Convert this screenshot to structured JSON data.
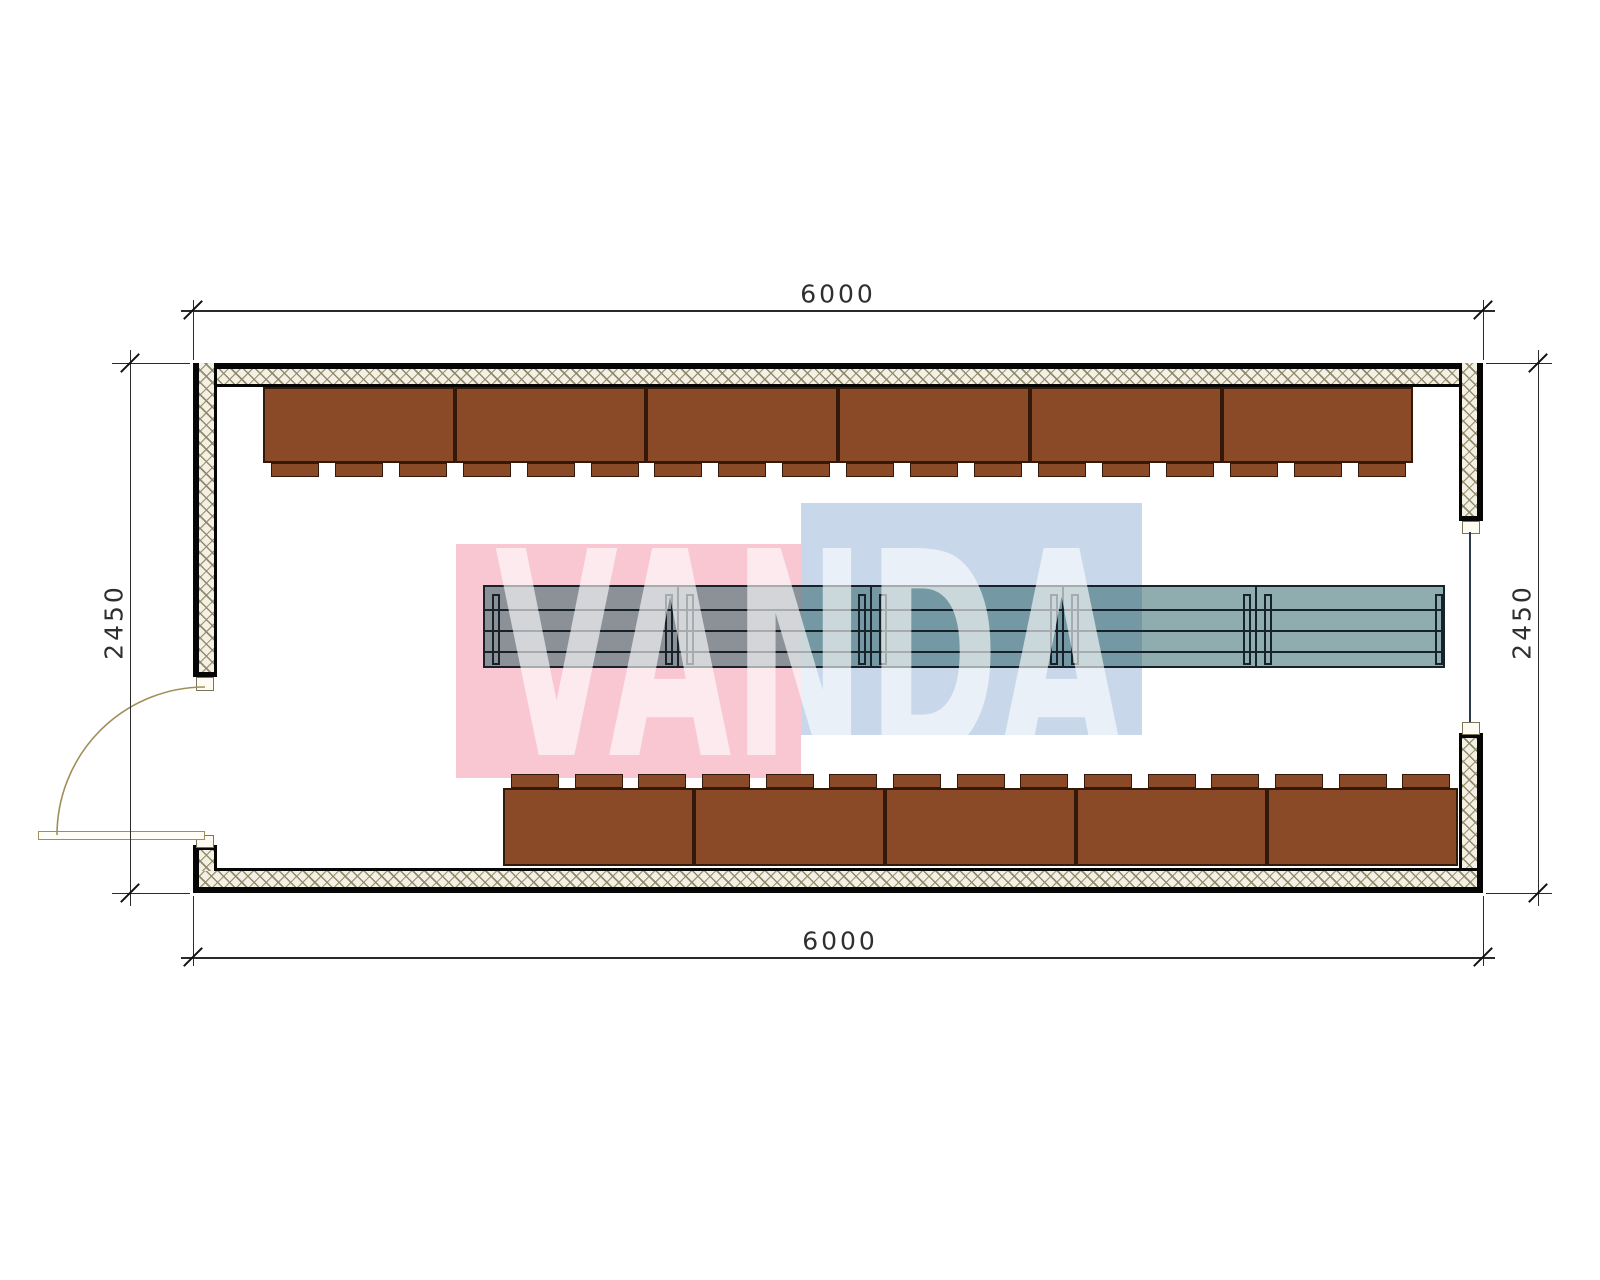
{
  "title": "container-floor-plan",
  "dimensions": {
    "top": {
      "label": "6000"
    },
    "bottom": {
      "label": "6000"
    },
    "left": {
      "label": "2450"
    },
    "right": {
      "label": "2450"
    }
  },
  "watermark": {
    "text": "VANDA",
    "pink_color": "#f8c7d2",
    "blue_color": "#c9d7ea",
    "text_color": "rgba(255,255,255,0.62)",
    "rects": [
      {
        "x": 456,
        "y": 544,
        "w": 345,
        "h": 234,
        "which": "pink"
      },
      {
        "x": 801,
        "y": 503,
        "w": 341,
        "h": 232,
        "which": "blue"
      }
    ],
    "text_box": {
      "left": 495,
      "top": 548,
      "font_px": 284,
      "line_px": 218,
      "scale_x": 0.56,
      "letter_spacing": 2
    }
  },
  "plan": {
    "colors": {
      "wall_border": "#060606",
      "bench_fill": "#8a4a28",
      "bench_border": "#33190a",
      "table_fill": "rgba(40,95,100,0.52)",
      "table_line": "#17222b",
      "door": "#9f8f5a",
      "dim_line": "#2a2a2a",
      "dim_text": "#2f2f2f"
    },
    "walls": [
      {
        "name": "wall-top",
        "x": 193,
        "y": 363,
        "w": 1290,
        "h": 24,
        "bt": 6,
        "bb": 3,
        "bl": 6,
        "br": 6
      },
      {
        "name": "wall-left",
        "x": 193,
        "y": 363,
        "w": 24,
        "h": 314,
        "bt": 0,
        "bb": 5,
        "bl": 6,
        "br": 3
      },
      {
        "name": "wall-right-upper",
        "x": 1459,
        "y": 363,
        "w": 24,
        "h": 158,
        "bt": 0,
        "bb": 5,
        "bl": 3,
        "br": 6
      },
      {
        "name": "wall-right-lower",
        "x": 1459,
        "y": 733,
        "w": 24,
        "h": 160,
        "bt": 5,
        "bb": 0,
        "bl": 3,
        "br": 6
      },
      {
        "name": "wall-bottom",
        "x": 193,
        "y": 868,
        "w": 1290,
        "h": 25,
        "bt": 3,
        "bb": 6,
        "bl": 6,
        "br": 6
      },
      {
        "name": "wall-bottom-left-corner",
        "x": 193,
        "y": 845,
        "w": 24,
        "h": 26,
        "bt": 5,
        "bb": 0,
        "bl": 6,
        "br": 3
      }
    ],
    "jamb_tabs": [
      {
        "x": 196,
        "y": 677,
        "w": 16,
        "h": 12
      },
      {
        "x": 196,
        "y": 835,
        "w": 16,
        "h": 11
      },
      {
        "x": 1462,
        "y": 521,
        "w": 16,
        "h": 11
      },
      {
        "x": 1462,
        "y": 722,
        "w": 16,
        "h": 11
      }
    ],
    "window_line": {
      "x": 1469,
      "y": 532,
      "w": 2,
      "h": 190
    },
    "benches_top": {
      "count": 6,
      "x0": 263,
      "pitch": 191.7,
      "body_y": 387,
      "body_h": 76,
      "tab_y": 463,
      "tab_h": 14,
      "tab_w": 48,
      "tab_offsets": [
        8,
        72,
        136
      ]
    },
    "benches_bottom": {
      "count": 5,
      "x0": 503,
      "pitch": 191,
      "body_y": 788,
      "body_h": 78,
      "tab_y": 774,
      "tab_h": 14,
      "tab_w": 48,
      "tab_offsets": [
        8,
        72,
        135
      ]
    },
    "table": {
      "x": 483,
      "y": 585,
      "w": 962,
      "h": 83,
      "hlines_dy": [
        22,
        43,
        64
      ],
      "vlines_dx": [
        192,
        385,
        577,
        770
      ],
      "legs_dx": [
        7,
        180,
        201,
        373,
        394,
        565,
        586,
        758,
        779,
        950
      ],
      "leg_dy": 7,
      "leg_h": 71,
      "leg_w": 8
    },
    "door": {
      "leaf": {
        "x": 38,
        "y": 831,
        "w": 167,
        "h": 9
      },
      "arc": {
        "x1": 57,
        "y1": 835,
        "x2": 205,
        "y2": 687,
        "r": 148
      }
    },
    "dims": {
      "top": {
        "line": {
          "x": 181,
          "y": 310,
          "len": 1314
        },
        "ticks": [
          [
            193,
            310
          ],
          [
            1483,
            310
          ]
        ],
        "ext": [
          {
            "x": 193,
            "y": 300,
            "h": 60
          },
          {
            "x": 1483,
            "y": 300,
            "h": 60
          }
        ],
        "text_at": [
          838,
          294
        ],
        "rot": 0
      },
      "bottom": {
        "line": {
          "x": 181,
          "y": 957,
          "len": 1314
        },
        "ticks": [
          [
            193,
            957
          ],
          [
            1483,
            957
          ]
        ],
        "ext": [
          {
            "x": 193,
            "y": 896,
            "h": 70
          },
          {
            "x": 1483,
            "y": 896,
            "h": 70
          }
        ],
        "text_at": [
          840,
          941
        ],
        "rot": 0
      },
      "left": {
        "vline": {
          "x": 130,
          "y": 350,
          "len": 556
        },
        "ticks": [
          [
            130,
            363
          ],
          [
            130,
            893
          ]
        ],
        "ext": [
          {
            "x": 112,
            "y": 363,
            "w": 78
          },
          {
            "x": 112,
            "y": 893,
            "w": 78
          }
        ],
        "text_at": [
          114,
          622
        ],
        "rot": -90
      },
      "right": {
        "vline": {
          "x": 1538,
          "y": 350,
          "len": 556
        },
        "ticks": [
          [
            1538,
            363
          ],
          [
            1538,
            893
          ]
        ],
        "ext": [
          {
            "x": 1486,
            "y": 363,
            "w": 66
          },
          {
            "x": 1486,
            "y": 893,
            "w": 66
          }
        ],
        "text_at": [
          1522,
          622
        ],
        "rot": -90
      }
    }
  }
}
